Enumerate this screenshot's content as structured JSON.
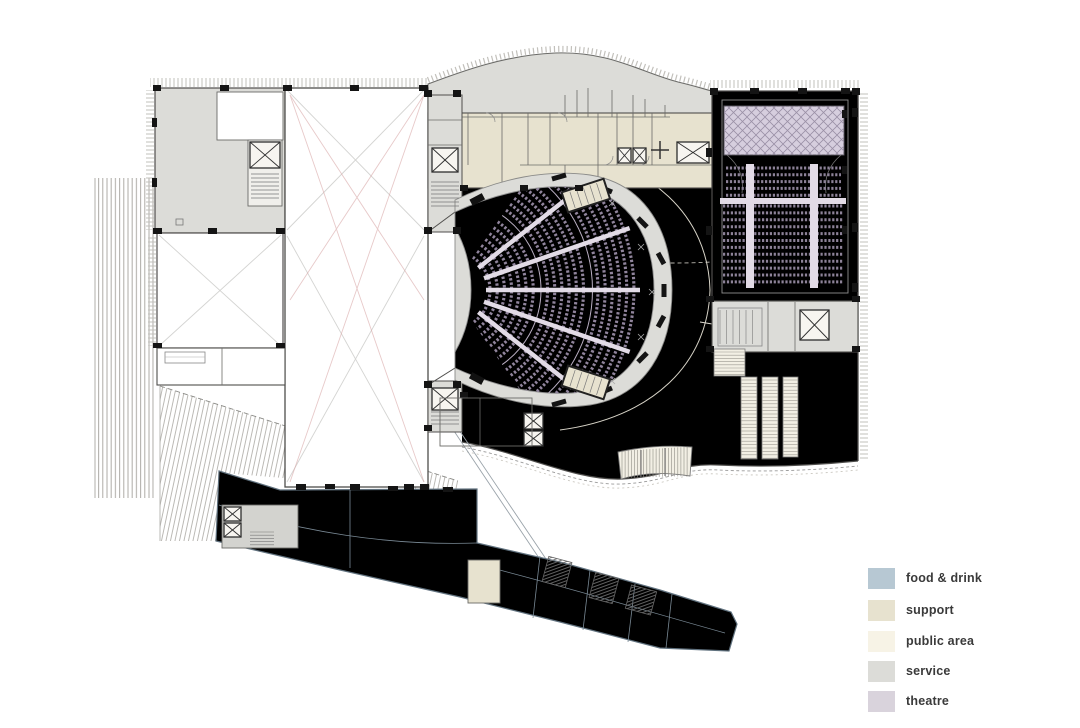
{
  "legend": {
    "items": [
      {
        "id": "food-drink",
        "label": "food & drink",
        "color": "#b7c8d3"
      },
      {
        "id": "support",
        "label": "support",
        "color": "#e7e2cf"
      },
      {
        "id": "public-area",
        "label": "public area",
        "color": "#f7f3e6"
      },
      {
        "id": "service",
        "label": "service",
        "color": "#dcdcd8"
      },
      {
        "id": "theatre",
        "label": "theatre",
        "color": "#d9d3dc"
      }
    ]
  },
  "colors": {
    "background": "#ffffff",
    "food_drink": "#b7c8d3",
    "support": "#e7e2cf",
    "public_area": "#f7f3e6",
    "service": "#dcdcd8",
    "theatre": "#d9d3dc",
    "theatre_room": "#e2dbe6",
    "wall": "#4f4e4c",
    "column": "#141414",
    "seat": "#90849c",
    "bracing": "#d8a6a6",
    "hatch": "#b3b1ad"
  }
}
